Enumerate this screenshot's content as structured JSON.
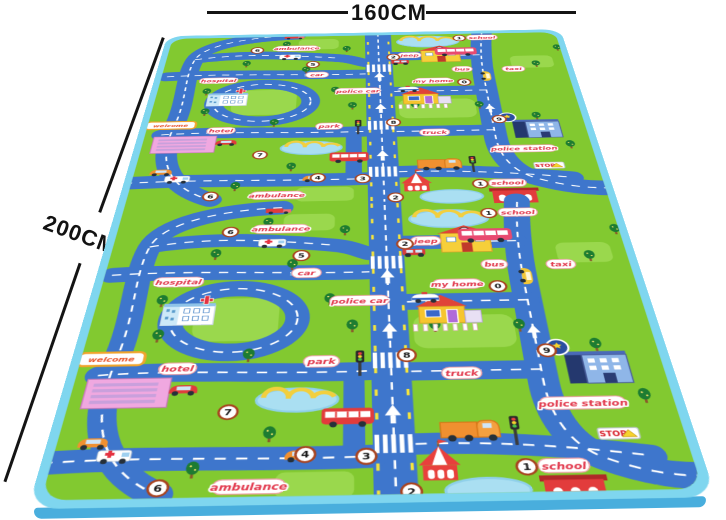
{
  "annotations": {
    "width_label": "160CM",
    "height_label": "200CM"
  },
  "colors": {
    "grass": "#82c930",
    "grass_light": "#9ad84d",
    "road": "#3e76cc",
    "border": "#7fd6ef",
    "edge": "#49aedd",
    "water": "#aadff2",
    "sand": "#f2cf3e",
    "tree": "#1d7c31",
    "label_red": "#e23a4e",
    "marker_ring": "#a8431f"
  },
  "mat": {
    "labels": {
      "hospital": "hospital",
      "hotel": "hotel",
      "welcome": "welcome",
      "ambulance": "ambulance",
      "car": "car",
      "police_car": "police car",
      "park": "park",
      "my_home": "my home",
      "truck": "truck",
      "jeep": "jeep",
      "bus": "bus",
      "taxi": "taxi",
      "school": "school",
      "police_station": "police station",
      "stop": "STOP"
    },
    "markers": [
      "6",
      "5",
      "2",
      "1",
      "0",
      "8",
      "9",
      "7",
      "4",
      "3",
      "2",
      "1",
      "6"
    ]
  }
}
